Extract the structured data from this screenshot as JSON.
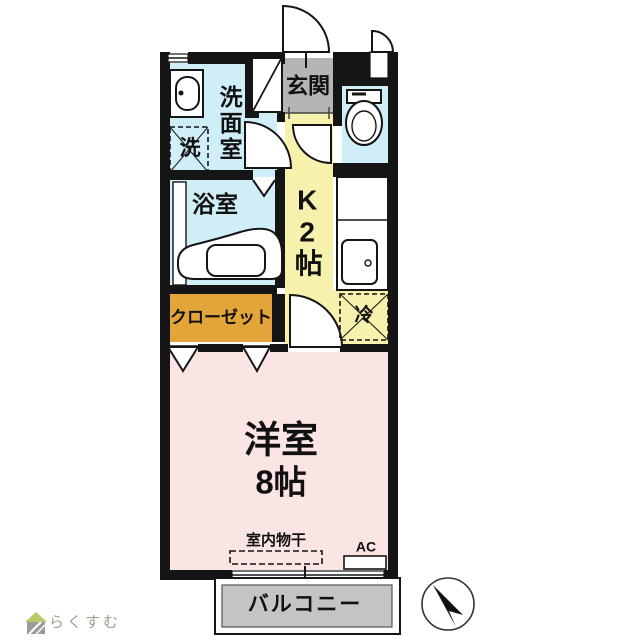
{
  "floorplan": {
    "rooms": {
      "genkan": {
        "label": "玄関"
      },
      "washroom": {
        "label": "洗面室"
      },
      "laundry": {
        "label": "洗"
      },
      "bathroom": {
        "label": "浴室"
      },
      "kitchen": {
        "label": "K2帖"
      },
      "fridge": {
        "label": "冷"
      },
      "closet": {
        "label": "クローゼット"
      },
      "main_room": {
        "name": "洋室",
        "size": "8帖"
      },
      "balcony": {
        "label": "バルコニー"
      }
    },
    "annotations": {
      "indoor_drying": "室内物干",
      "ac": "AC"
    },
    "icons": {
      "compass": "north-arrow-icon",
      "logo_house": "house-icon",
      "toilet": "toilet-icon",
      "bathtub": "bathtub-icon",
      "sink": "kitchen-sink-icon",
      "washbasin": "washbasin-icon"
    },
    "colors": {
      "wall": "#151515",
      "water_rooms": "#cfeef8",
      "kitchen": "#f6f2ae",
      "genkan": "#b5b5b5",
      "closet": "#e3a43a",
      "main_room": "#fae4e4",
      "balcony": "#c4c4c4"
    }
  },
  "branding": {
    "logo_text": "らくすむ",
    "logo_color": "#a39b8d"
  }
}
